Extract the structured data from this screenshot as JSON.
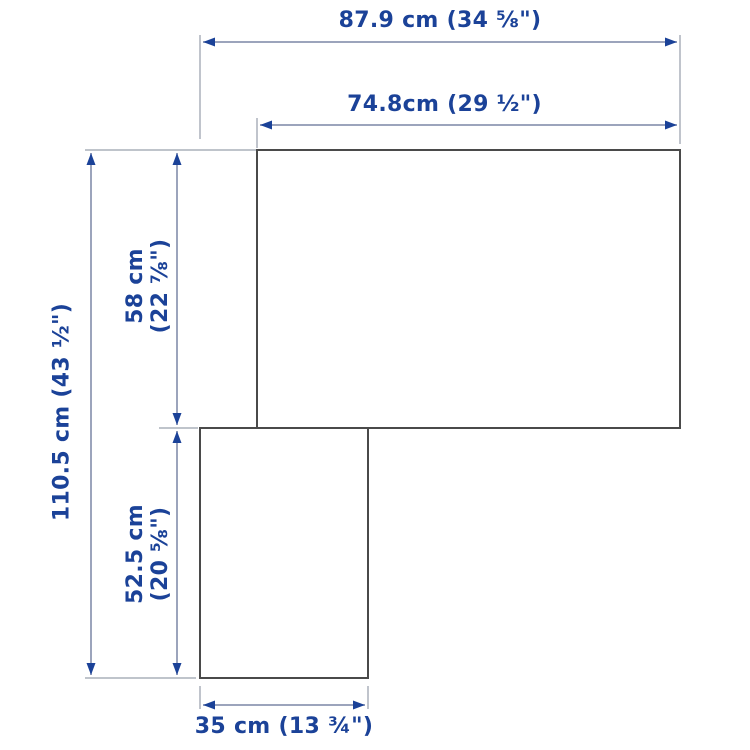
{
  "diagram": {
    "kind": "product-dimension-diagram",
    "shape": "l-shaped-top-view",
    "colors": {
      "background": "#ffffff",
      "label_text": "#1b4298",
      "arrowhead": "#1b4298",
      "dimension_line": "#7c86a6",
      "extension_line": "#aab0ba",
      "shape_outline": "#4a4a4a"
    },
    "dims": {
      "total_width": "87.9 cm (34 ⅝\")",
      "upper_width": "74.8cm (29 ½\")",
      "total_height": "110.5 cm (43 ½\")",
      "upper_height_cm": "58 cm",
      "upper_height_in": "(22 ⅞\")",
      "lower_height_cm": "52.5 cm",
      "lower_height_in": "(20 ⅝\")",
      "bottom_width": "35 cm (13 ¾\")"
    }
  }
}
